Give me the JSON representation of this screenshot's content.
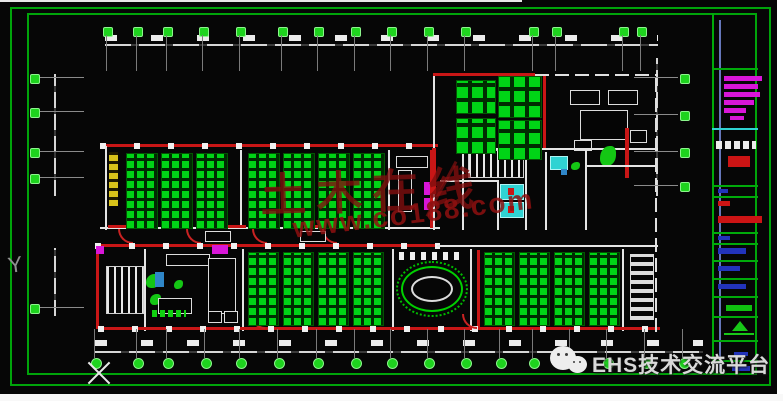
{
  "app": {
    "type": "cad-floorplan-viewport"
  },
  "palette": {
    "background": "#060606",
    "frame_green": "#00a40a",
    "furniture_green": "#00d416",
    "wall_red": "#c81616",
    "wall_white": "#e4e4e4",
    "fixture_magenta": "#d816d8",
    "fixture_cyan": "#2fd3d3",
    "stair_yellow": "#d8c21a",
    "panel_blue_line": "#6677bb",
    "marker_green": "#1ed31e"
  },
  "watermark_center": {
    "line1": "土木在线",
    "line2": "www.co188.com"
  },
  "watermark_footer": {
    "text": "EHS技术交流平台",
    "icon": "wechat-icon"
  },
  "ucs": {
    "y_axis_label": "Y"
  },
  "grid": {
    "top_x": [
      107,
      137,
      167,
      203,
      240,
      282,
      318,
      355,
      391,
      428,
      465,
      533,
      556,
      623,
      641
    ],
    "bottom_x": [
      95,
      137,
      167,
      205,
      240,
      278,
      317,
      355,
      391,
      428,
      465,
      500,
      533,
      570,
      607,
      645,
      683
    ],
    "left_y": [
      78,
      112,
      152,
      178,
      308
    ],
    "right_y": [
      78,
      115,
      152,
      186
    ]
  },
  "workstations": {
    "upper": {
      "y": 153,
      "h": 74,
      "w": 30,
      "x": [
        126,
        161,
        196,
        248,
        283,
        318,
        353
      ]
    },
    "lower_a": {
      "y": 252,
      "h": 72,
      "w": 29,
      "x": [
        248,
        283,
        318,
        353
      ]
    },
    "lower_b": {
      "y": 252,
      "h": 72,
      "w": 29,
      "x": [
        484,
        519,
        554,
        589
      ]
    },
    "meeting_tables": [
      {
        "x": 456,
        "y": 80,
        "w": 38,
        "h": 32
      },
      {
        "x": 498,
        "y": 76,
        "w": 42,
        "h": 40
      },
      {
        "x": 456,
        "y": 118,
        "w": 38,
        "h": 34
      },
      {
        "x": 498,
        "y": 120,
        "w": 42,
        "h": 38
      }
    ]
  },
  "panel": {
    "dividers": [
      {
        "y": 68,
        "c": "#00aa0a"
      },
      {
        "y": 128,
        "c": "#2fd3d3"
      },
      {
        "y": 185,
        "c": "#00aa0a"
      },
      {
        "y": 196,
        "c": "#00aa0a"
      },
      {
        "y": 232,
        "c": "#00aa0a"
      },
      {
        "y": 243,
        "c": "#00aa0a"
      },
      {
        "y": 260,
        "c": "#00aa0a"
      },
      {
        "y": 278,
        "c": "#00aa0a"
      },
      {
        "y": 296,
        "c": "#00aa0a"
      },
      {
        "y": 316,
        "c": "#00aa0a"
      },
      {
        "y": 340,
        "c": "#00aa0a"
      },
      {
        "y": 360,
        "c": "#00aa0a"
      }
    ],
    "bars": [
      {
        "x": 724,
        "y": 76,
        "w": 38,
        "h": 5,
        "c": "#d816d8"
      },
      {
        "x": 724,
        "y": 84,
        "w": 34,
        "h": 5,
        "c": "#d816d8"
      },
      {
        "x": 724,
        "y": 92,
        "w": 36,
        "h": 5,
        "c": "#d816d8"
      },
      {
        "x": 724,
        "y": 100,
        "w": 30,
        "h": 5,
        "c": "#d816d8"
      },
      {
        "x": 724,
        "y": 108,
        "w": 22,
        "h": 5,
        "c": "#d816d8"
      },
      {
        "x": 730,
        "y": 116,
        "w": 14,
        "h": 4,
        "c": "#d816d8"
      },
      {
        "x": 716,
        "y": 141,
        "w": 40,
        "h": 8,
        "c": "wtext"
      },
      {
        "x": 728,
        "y": 156,
        "w": 22,
        "h": 11,
        "c": "#cc1414"
      },
      {
        "x": 718,
        "y": 189,
        "w": 10,
        "h": 4,
        "c": "#2233bb"
      },
      {
        "x": 718,
        "y": 201,
        "w": 12,
        "h": 5,
        "c": "#cc1414"
      },
      {
        "x": 718,
        "y": 216,
        "w": 44,
        "h": 7,
        "c": "#cc1414"
      },
      {
        "x": 718,
        "y": 236,
        "w": 12,
        "h": 4,
        "c": "#2233bb"
      },
      {
        "x": 718,
        "y": 248,
        "w": 28,
        "h": 6,
        "c": "#2233bb"
      },
      {
        "x": 718,
        "y": 266,
        "w": 22,
        "h": 5,
        "c": "#2233bb"
      },
      {
        "x": 718,
        "y": 284,
        "w": 28,
        "h": 5,
        "c": "#2233bb"
      },
      {
        "x": 726,
        "y": 305,
        "w": 26,
        "h": 6,
        "c": "#10c010"
      },
      {
        "x": 734,
        "y": 352,
        "w": 14,
        "h": 4,
        "c": "#2233bb"
      },
      {
        "x": 732,
        "y": 366,
        "w": 18,
        "h": 5,
        "c": "#2233bb"
      }
    ]
  }
}
